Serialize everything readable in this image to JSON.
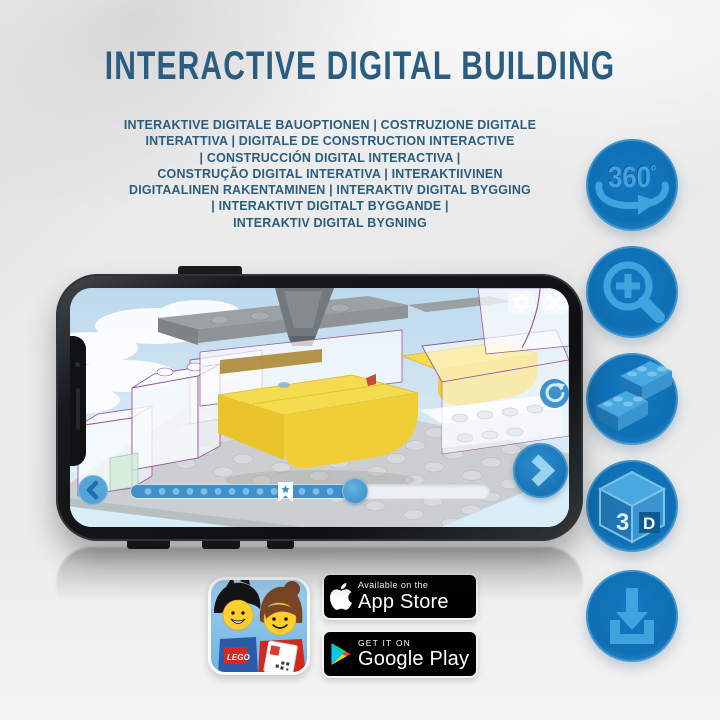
{
  "header": {
    "title": "INTERACTIVE DIGITAL BUILDING"
  },
  "subtitle": {
    "lines": [
      "INTERAKTIVE DIGITALE BAUOPTIONEN | COSTRUZIONE DIGITALE",
      "INTERATTIVA | DIGITALE DE CONSTRUCTION INTERACTIVE",
      "| CONSTRUCCIÓN DIGITAL INTERACTIVA |",
      "CONSTRUÇÃO DIGITAL INTERATIVA | INTERAKTIIVINEN",
      "DIGITAALINEN RAKENTAMINEN | INTERAKTIV DIGITAL BYGGING",
      "| INTERAKTIVT DIGITALT BYGGANDE |",
      "INTERAKTIV DIGITAL BYGNING"
    ]
  },
  "features": [
    {
      "name": "360-rotation",
      "label": "360",
      "degree": "º"
    },
    {
      "name": "zoom-in"
    },
    {
      "name": "digital-bricks"
    },
    {
      "name": "3d-view",
      "label_3": "3",
      "label_d": "D"
    },
    {
      "name": "download"
    }
  ],
  "store": {
    "lego_logo": "LEGO",
    "app_store": {
      "tagline": "Available on the",
      "name": "App Store"
    },
    "google_play": {
      "tagline": "GET IT ON",
      "name": "Google Play"
    }
  },
  "colors": {
    "title_text": "#2a5d80",
    "accent_circle": "#0f6fb4",
    "icon_glyph": "#41a3de",
    "progress_blue": "#4091c9",
    "brick_yellow": "#f5db4f",
    "outline_purple": "#9b56a0",
    "phone_body": "#141618",
    "screen_sky": "#cfe4f2"
  }
}
